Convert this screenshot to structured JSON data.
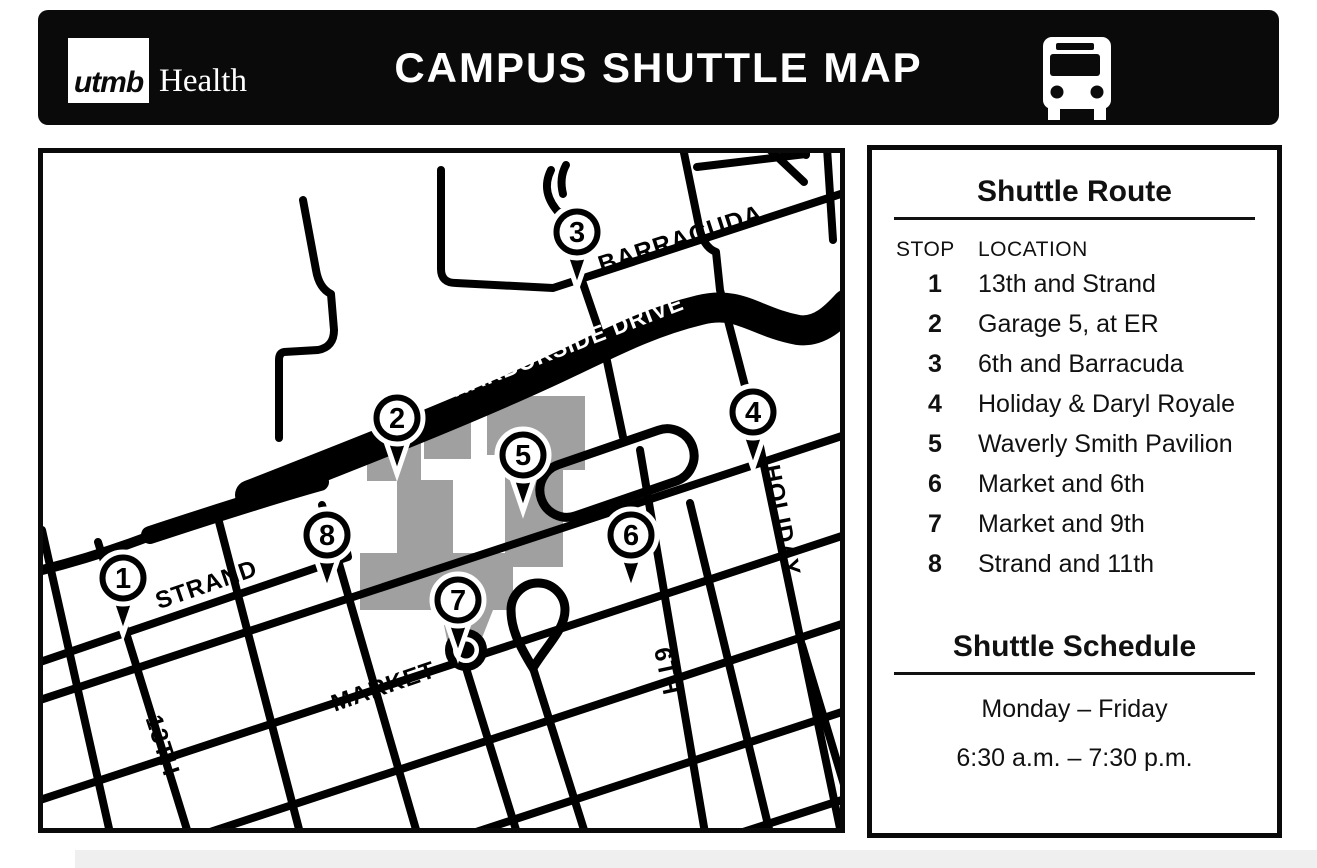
{
  "header": {
    "logo_utmb": "utmb",
    "logo_health": "Health",
    "title": "CAMPUS SHUTTLE MAP",
    "bus_icon": "bus-icon"
  },
  "route_panel": {
    "title": "Shuttle Route",
    "col_stop": "STOP",
    "col_location": "LOCATION",
    "stops": [
      {
        "num": "1",
        "location": "13th and Strand"
      },
      {
        "num": "2",
        "location": "Garage 5, at ER"
      },
      {
        "num": "3",
        "location": "6th and Barracuda"
      },
      {
        "num": "4",
        "location": "Holiday & Daryl Royale"
      },
      {
        "num": "5",
        "location": "Waverly Smith Pavilion"
      },
      {
        "num": "6",
        "location": "Market and 6th"
      },
      {
        "num": "7",
        "location": "Market and 9th"
      },
      {
        "num": "8",
        "location": "Strand and 11th"
      }
    ]
  },
  "schedule_panel": {
    "title": "Shuttle Schedule",
    "days": "Monday – Friday",
    "hours": "6:30 a.m. – 7:30 p.m."
  },
  "map": {
    "street_labels": [
      {
        "id": "barracuda",
        "text": "BARRACUDA",
        "x": 683,
        "y": 247,
        "rotate": -18,
        "size": 25,
        "color": "#000000"
      },
      {
        "id": "harborside",
        "text": "HARBORSIDE DRIVE",
        "x": 570,
        "y": 353,
        "rotate": -21,
        "size": 23,
        "color": "#ffffff"
      },
      {
        "id": "strand",
        "text": "STRAND",
        "x": 209,
        "y": 592,
        "rotate": -19,
        "size": 24,
        "color": "#000000"
      },
      {
        "id": "market",
        "text": "MARKET",
        "x": 386,
        "y": 694,
        "rotate": -19,
        "size": 24,
        "color": "#000000"
      },
      {
        "id": "13th",
        "text": "13TH",
        "x": 155,
        "y": 748,
        "rotate": 72,
        "size": 24,
        "color": "#000000"
      },
      {
        "id": "6th",
        "text": "6TH",
        "x": 659,
        "y": 673,
        "rotate": 78,
        "size": 24,
        "color": "#000000"
      },
      {
        "id": "holiday",
        "text": "HOLIDAY",
        "x": 774,
        "y": 522,
        "rotate": 79,
        "size": 24,
        "color": "#000000"
      }
    ],
    "stops": [
      {
        "num": "1",
        "x": 123,
        "y": 578
      },
      {
        "num": "2",
        "x": 397,
        "y": 418
      },
      {
        "num": "3",
        "x": 577,
        "y": 232
      },
      {
        "num": "4",
        "x": 753,
        "y": 412
      },
      {
        "num": "5",
        "x": 523,
        "y": 455
      },
      {
        "num": "6",
        "x": 631,
        "y": 535
      },
      {
        "num": "7",
        "x": 458,
        "y": 600
      },
      {
        "num": "8",
        "x": 327,
        "y": 535
      }
    ]
  },
  "colors": {
    "header_bg": "#0a0a0a",
    "street_black": "#000000",
    "building_gray": "#a0a0a0",
    "footer_strip": "#efefef"
  }
}
